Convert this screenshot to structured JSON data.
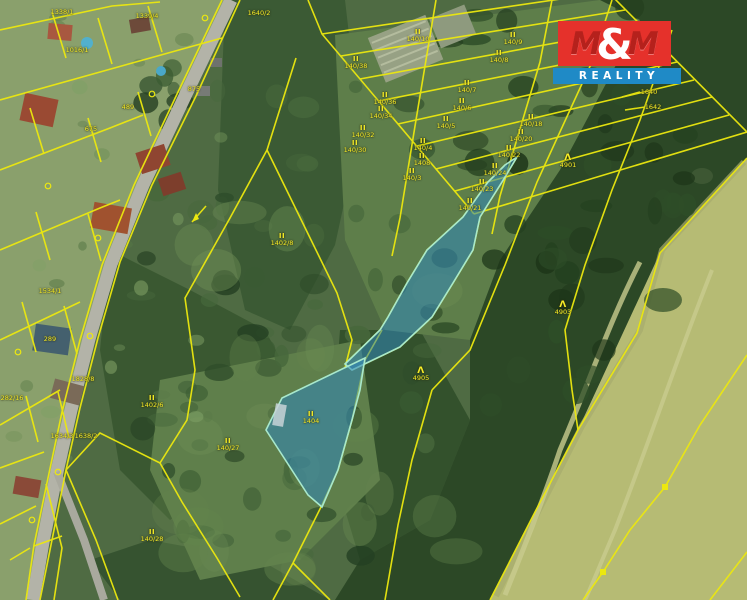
{
  "logo": {
    "m1": "M",
    "amp": "&",
    "m2": "M",
    "reality": "REALITY",
    "red": "#e5312b",
    "red_dark": "#b5211c",
    "blue": "#1f8ac6",
    "text_color": "#ffffff"
  },
  "map": {
    "highlight_fill": "#2f86ba",
    "highlight_stroke": "#a8e8cc",
    "cadastral_line_color": "#ece80f",
    "label_color": "#f6ee28",
    "symbols": {
      "grassland": "II",
      "coniferous_forest": "Λ"
    },
    "parcels": [
      {
        "n": "1338/1",
        "x": 62,
        "y": 12,
        "s": ""
      },
      {
        "n": "1339/4",
        "x": 147,
        "y": 16,
        "s": ""
      },
      {
        "n": "1016/1",
        "x": 77,
        "y": 50,
        "s": ""
      },
      {
        "n": "489",
        "x": 128,
        "y": 107,
        "s": ""
      },
      {
        "n": "675",
        "x": 91,
        "y": 129,
        "s": ""
      },
      {
        "n": "875",
        "x": 194,
        "y": 89,
        "s": ""
      },
      {
        "n": "1640/2",
        "x": 259,
        "y": 13,
        "s": ""
      },
      {
        "n": "1534/1",
        "x": 50,
        "y": 291,
        "s": ""
      },
      {
        "n": "289",
        "x": 50,
        "y": 339,
        "s": ""
      },
      {
        "n": "282/16",
        "x": 12,
        "y": 398,
        "s": ""
      },
      {
        "n": "1634/3",
        "x": 62,
        "y": 436,
        "s": ""
      },
      {
        "n": "1638/2",
        "x": 86,
        "y": 436,
        "s": ""
      },
      {
        "n": "1828/8",
        "x": 83,
        "y": 379,
        "s": ""
      },
      {
        "n": "140/10",
        "x": 418,
        "y": 37,
        "s": "II"
      },
      {
        "n": "140/9",
        "x": 513,
        "y": 40,
        "s": "II"
      },
      {
        "n": "140/8",
        "x": 499,
        "y": 58,
        "s": "II"
      },
      {
        "n": "140/7",
        "x": 467,
        "y": 88,
        "s": "II"
      },
      {
        "n": "140/6",
        "x": 462,
        "y": 106,
        "s": "II"
      },
      {
        "n": "140/5",
        "x": 446,
        "y": 124,
        "s": "II"
      },
      {
        "n": "140/4",
        "x": 423,
        "y": 146,
        "s": "II"
      },
      {
        "n": "1408",
        "x": 422,
        "y": 161,
        "s": "II"
      },
      {
        "n": "140/3",
        "x": 412,
        "y": 176,
        "s": "II"
      },
      {
        "n": "140/38",
        "x": 356,
        "y": 64,
        "s": "II"
      },
      {
        "n": "140/36",
        "x": 385,
        "y": 100,
        "s": "II"
      },
      {
        "n": "140/34",
        "x": 381,
        "y": 114,
        "s": "II"
      },
      {
        "n": "140/32",
        "x": 363,
        "y": 133,
        "s": "II"
      },
      {
        "n": "140/30",
        "x": 355,
        "y": 148,
        "s": "II"
      },
      {
        "n": "140/18",
        "x": 531,
        "y": 122,
        "s": "II"
      },
      {
        "n": "140/20",
        "x": 521,
        "y": 137,
        "s": "II"
      },
      {
        "n": "140/22",
        "x": 509,
        "y": 153,
        "s": "II"
      },
      {
        "n": "140/24",
        "x": 495,
        "y": 171,
        "s": "II"
      },
      {
        "n": "140/23",
        "x": 482,
        "y": 187,
        "s": "II"
      },
      {
        "n": "140/21",
        "x": 470,
        "y": 206,
        "s": "II"
      },
      {
        "n": "1640",
        "x": 649,
        "y": 92,
        "s": ""
      },
      {
        "n": "1642",
        "x": 653,
        "y": 107,
        "s": ""
      },
      {
        "n": "1402/8",
        "x": 282,
        "y": 241,
        "s": "II"
      },
      {
        "n": "1402/6",
        "x": 152,
        "y": 403,
        "s": "II"
      },
      {
        "n": "140/27",
        "x": 228,
        "y": 446,
        "s": "II"
      },
      {
        "n": "140/28",
        "x": 152,
        "y": 537,
        "s": "II"
      },
      {
        "n": "1404",
        "x": 311,
        "y": 419,
        "s": "II"
      },
      {
        "n": "4905",
        "x": 421,
        "y": 376,
        "s": "Λ"
      },
      {
        "n": "4901",
        "x": 568,
        "y": 163,
        "s": "Λ"
      },
      {
        "n": "4903",
        "x": 563,
        "y": 310,
        "s": "Λ"
      }
    ]
  }
}
